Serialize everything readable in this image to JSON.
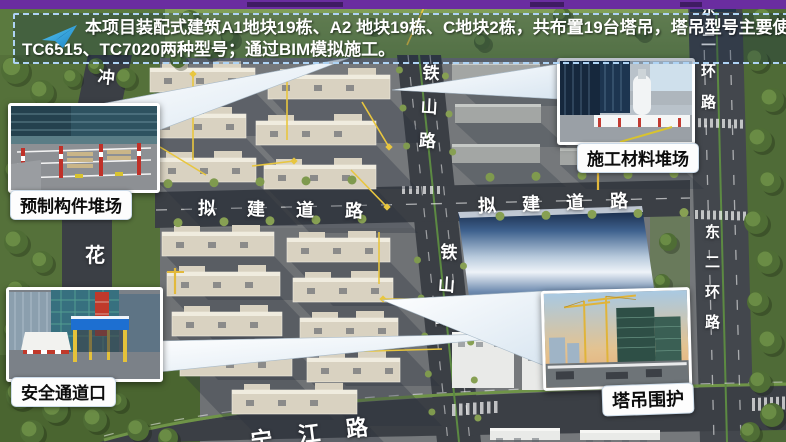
{
  "slide": {
    "top_strip_color": "#6a2da0",
    "banner": {
      "icon": "paper-plane-arrow-icon",
      "line1": "本项目装配式建筑A1地块19栋、A2 地块19栋、C地块2栋，共布置19台塔吊，塔吊型号主要使用",
      "line2": "TC6515、TC7020两种型号；通过BIM模拟施工。",
      "border_color": "#aed3f4",
      "text_color": "#ffffff"
    },
    "callouts": {
      "precast": {
        "label": "预制构件堆场"
      },
      "material": {
        "label": "施工材料堆场"
      },
      "safety": {
        "label": "安全通道口"
      },
      "crane": {
        "label": "塔吊围护"
      }
    },
    "roads": {
      "tieshan_north": "铁山路",
      "tieshan_south": "铁山路",
      "proposed_west": "拟建道路",
      "proposed_east": "拟建道路",
      "east_ring_north": "东二环路",
      "east_ring_south": "东二环路",
      "hua_partial": "花",
      "chong_partial": "冲",
      "ningjiang": "宁江路"
    },
    "colors": {
      "leader_line_yellow": "#e8c63f",
      "road_asphalt": "#3b3f45",
      "forest_green": "#4e6a35"
    }
  }
}
